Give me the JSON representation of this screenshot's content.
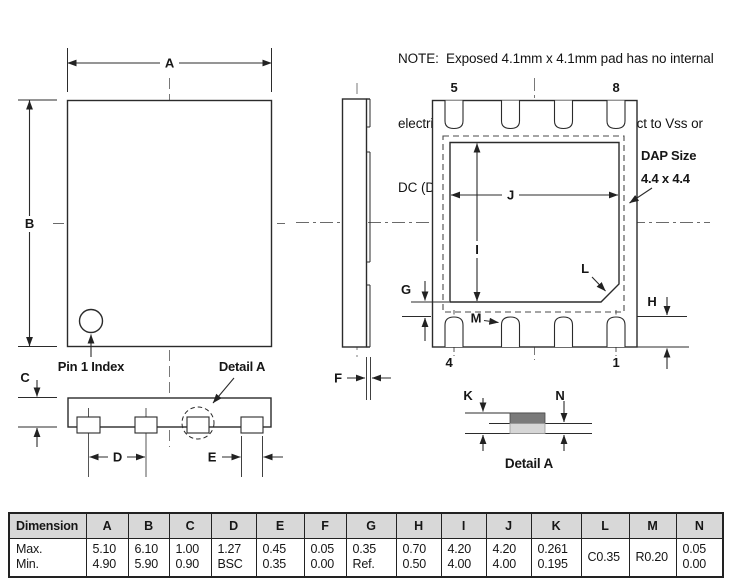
{
  "note": {
    "line1": "NOTE:  Exposed 4.1mm x 4.1mm pad has no internal",
    "line2": "electrical connection -recommend connect to Vss or",
    "line3": "DC (Do Not Connect”)"
  },
  "drawing": {
    "dims": {
      "a": "A",
      "b": "B",
      "c": "C",
      "d": "D",
      "e": "E",
      "f": "F",
      "g": "G",
      "h": "H",
      "i": "I",
      "j": "J",
      "k": "K",
      "l": "L",
      "m": "M",
      "n": "N"
    },
    "pin1_index": "Pin 1 Index",
    "detail_a_callout": "Detail A",
    "detail_a_caption": "Detail A",
    "dap_size_line1": "DAP Size",
    "dap_size_line2": "4.4 x 4.4",
    "pins": {
      "top_left": "5",
      "top_right": "8",
      "bottom_left": "4",
      "bottom_right": "1"
    }
  },
  "table": {
    "header": [
      "Dimension",
      "A",
      "B",
      "C",
      "D",
      "E",
      "F",
      "G",
      "H",
      "I",
      "J",
      "K",
      "L",
      "M",
      "N"
    ],
    "row_labels": [
      "Max.",
      "Min."
    ],
    "max": [
      "5.10",
      "6.10",
      "1.00",
      "1.27",
      "0.45",
      "0.05",
      "0.35",
      "0.70",
      "4.20",
      "4.20",
      "0.261",
      "C0.35",
      "R0.20",
      "0.05"
    ],
    "min": [
      "4.90",
      "5.90",
      "0.90",
      "BSC",
      "0.35",
      "0.00",
      "Ref.",
      "0.50",
      "4.00",
      "4.00",
      "0.195",
      "",
      "",
      "0.00"
    ]
  },
  "colors": {
    "line": "#2b2b2b",
    "table_header_bg": "#d8d8d8",
    "pad_dark": "#7a7a7a",
    "pad_light": "#d6d6d6"
  }
}
